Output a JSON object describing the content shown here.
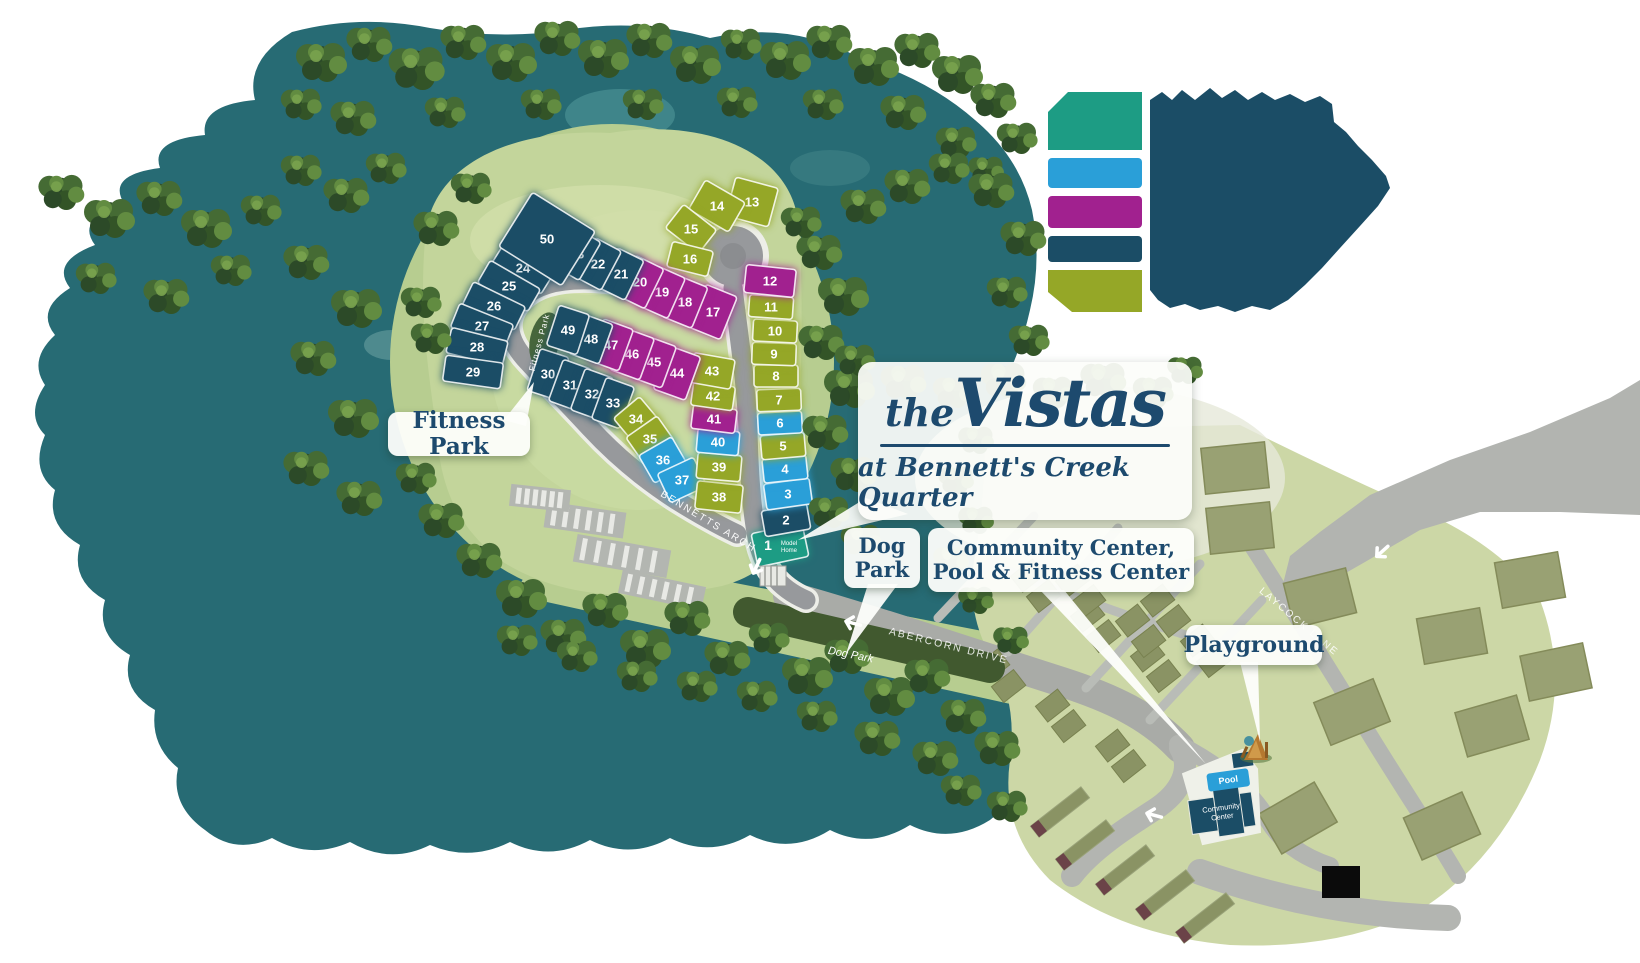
{
  "title": {
    "prefix": "the",
    "name": "Vistas",
    "subtitle": "at Bennett's Creek Quarter"
  },
  "callouts": {
    "fitness_park": "Fitness Park",
    "dog_park_line1": "Dog",
    "dog_park_line2": "Park",
    "community_line1": "Community Center,",
    "community_line2": "Pool & Fitness Center",
    "playground": "Playground"
  },
  "streets": {
    "bennetts_arch": "BENNETTS ARCH",
    "abercorn_drive": "ABERCORN DRIVE",
    "laycock_lane": "LAYCOCK LANE",
    "fitness_park_road": "Fitness Park"
  },
  "park_labels": {
    "dog_park_strip": "Dog Park"
  },
  "amenities": {
    "pool": "Pool",
    "community_center_line1": "Community",
    "community_center_line2": "Center",
    "model_home_number": "1",
    "model_home_line1": "Model",
    "model_home_line2": "Home"
  },
  "legend": {
    "swatches": [
      {
        "name": "teal",
        "hex": "#1d9c84"
      },
      {
        "name": "blue",
        "hex": "#2a9fd8"
      },
      {
        "name": "purple",
        "hex": "#a1218f"
      },
      {
        "name": "navy",
        "hex": "#1b4d66"
      },
      {
        "name": "olive",
        "hex": "#95a727"
      }
    ]
  },
  "lot_categories": {
    "navy": "#1b4d66",
    "olive": "#95a727",
    "purple": "#a1218f",
    "blue": "#2a9fd8",
    "teal": "#1d9c84"
  },
  "lots": [
    {
      "n": "1",
      "cat": "teal",
      "x": 780,
      "y": 545,
      "w": 52,
      "h": 34,
      "r": -12,
      "model_home": true
    },
    {
      "n": "2",
      "cat": "navy",
      "x": 786,
      "y": 520,
      "w": 46,
      "h": 26,
      "r": -10
    },
    {
      "n": "3",
      "cat": "blue",
      "x": 788,
      "y": 494,
      "w": 46,
      "h": 26,
      "r": -8
    },
    {
      "n": "4",
      "cat": "blue",
      "x": 785,
      "y": 469,
      "w": 44,
      "h": 24,
      "r": -6
    },
    {
      "n": "5",
      "cat": "olive",
      "x": 783,
      "y": 446,
      "w": 44,
      "h": 24,
      "r": -5
    },
    {
      "n": "6",
      "cat": "blue",
      "x": 780,
      "y": 423,
      "w": 44,
      "h": 22,
      "r": -3
    },
    {
      "n": "7",
      "cat": "olive",
      "x": 779,
      "y": 400,
      "w": 44,
      "h": 22,
      "r": -2
    },
    {
      "n": "8",
      "cat": "olive",
      "x": 776,
      "y": 376,
      "w": 44,
      "h": 22,
      "r": 0
    },
    {
      "n": "9",
      "cat": "olive",
      "x": 774,
      "y": 354,
      "w": 44,
      "h": 22,
      "r": 2
    },
    {
      "n": "10",
      "cat": "olive",
      "x": 775,
      "y": 331,
      "w": 44,
      "h": 22,
      "r": 3
    },
    {
      "n": "11",
      "cat": "olive",
      "x": 771,
      "y": 307,
      "w": 44,
      "h": 22,
      "r": 4
    },
    {
      "n": "12",
      "cat": "purple",
      "x": 770,
      "y": 281,
      "w": 50,
      "h": 28,
      "r": 6
    },
    {
      "n": "13",
      "cat": "olive",
      "x": 752,
      "y": 202,
      "w": 44,
      "h": 40,
      "r": 15
    },
    {
      "n": "14",
      "cat": "olive",
      "x": 717,
      "y": 206,
      "w": 46,
      "h": 34,
      "r": 30
    },
    {
      "n": "15",
      "cat": "olive",
      "x": 691,
      "y": 229,
      "w": 42,
      "h": 30,
      "r": 38
    },
    {
      "n": "16",
      "cat": "olive",
      "x": 690,
      "y": 259,
      "w": 42,
      "h": 26,
      "r": 14
    },
    {
      "n": "17",
      "cat": "purple",
      "x": 713,
      "y": 312,
      "w": 34,
      "h": 46,
      "r": 22
    },
    {
      "n": "18",
      "cat": "purple",
      "x": 685,
      "y": 302,
      "w": 32,
      "h": 44,
      "r": 22
    },
    {
      "n": "19",
      "cat": "purple",
      "x": 662,
      "y": 292,
      "w": 32,
      "h": 44,
      "r": 24
    },
    {
      "n": "20",
      "cat": "purple",
      "x": 640,
      "y": 282,
      "w": 32,
      "h": 44,
      "r": 26
    },
    {
      "n": "21",
      "cat": "navy",
      "x": 621,
      "y": 274,
      "w": 30,
      "h": 44,
      "r": 26
    },
    {
      "n": "22",
      "cat": "navy",
      "x": 598,
      "y": 264,
      "w": 30,
      "h": 44,
      "r": 28
    },
    {
      "n": "23",
      "cat": "navy",
      "x": 577,
      "y": 254,
      "w": 30,
      "h": 44,
      "r": 30
    },
    {
      "n": "24",
      "cat": "navy",
      "x": 523,
      "y": 268,
      "w": 58,
      "h": 26,
      "r": 32
    },
    {
      "n": "25",
      "cat": "navy",
      "x": 509,
      "y": 286,
      "w": 58,
      "h": 26,
      "r": 30
    },
    {
      "n": "26",
      "cat": "navy",
      "x": 494,
      "y": 306,
      "w": 58,
      "h": 26,
      "r": 26
    },
    {
      "n": "27",
      "cat": "navy",
      "x": 482,
      "y": 326,
      "w": 58,
      "h": 26,
      "r": 22
    },
    {
      "n": "28",
      "cat": "navy",
      "x": 477,
      "y": 347,
      "w": 58,
      "h": 26,
      "r": 14
    },
    {
      "n": "29",
      "cat": "navy",
      "x": 473,
      "y": 372,
      "w": 58,
      "h": 26,
      "r": 8
    },
    {
      "n": "30",
      "cat": "navy",
      "x": 548,
      "y": 374,
      "w": 30,
      "h": 44,
      "r": 18
    },
    {
      "n": "31",
      "cat": "navy",
      "x": 570,
      "y": 385,
      "w": 30,
      "h": 44,
      "r": 20
    },
    {
      "n": "32",
      "cat": "navy",
      "x": 592,
      "y": 394,
      "w": 30,
      "h": 44,
      "r": 20
    },
    {
      "n": "33",
      "cat": "navy",
      "x": 613,
      "y": 403,
      "w": 30,
      "h": 44,
      "r": 20
    },
    {
      "n": "34",
      "cat": "olive",
      "x": 636,
      "y": 419,
      "w": 34,
      "h": 30,
      "r": -40
    },
    {
      "n": "35",
      "cat": "olive",
      "x": 650,
      "y": 439,
      "w": 38,
      "h": 30,
      "r": -35
    },
    {
      "n": "36",
      "cat": "blue",
      "x": 663,
      "y": 460,
      "w": 38,
      "h": 32,
      "r": -30
    },
    {
      "n": "37",
      "cat": "blue",
      "x": 682,
      "y": 480,
      "w": 40,
      "h": 32,
      "r": -25
    },
    {
      "n": "38",
      "cat": "olive",
      "x": 719,
      "y": 497,
      "w": 46,
      "h": 28,
      "r": 6
    },
    {
      "n": "39",
      "cat": "olive",
      "x": 719,
      "y": 467,
      "w": 44,
      "h": 26,
      "r": 5
    },
    {
      "n": "40",
      "cat": "blue",
      "x": 718,
      "y": 442,
      "w": 42,
      "h": 24,
      "r": 5
    },
    {
      "n": "41",
      "cat": "purple",
      "x": 714,
      "y": 419,
      "w": 44,
      "h": 24,
      "r": 7
    },
    {
      "n": "42",
      "cat": "olive",
      "x": 713,
      "y": 396,
      "w": 42,
      "h": 24,
      "r": 8
    },
    {
      "n": "43",
      "cat": "olive",
      "x": 712,
      "y": 371,
      "w": 42,
      "h": 30,
      "r": 10
    },
    {
      "n": "44",
      "cat": "purple",
      "x": 677,
      "y": 373,
      "w": 34,
      "h": 46,
      "r": 20
    },
    {
      "n": "45",
      "cat": "purple",
      "x": 654,
      "y": 362,
      "w": 32,
      "h": 44,
      "r": 20
    },
    {
      "n": "46",
      "cat": "purple",
      "x": 632,
      "y": 354,
      "w": 32,
      "h": 44,
      "r": 20
    },
    {
      "n": "47",
      "cat": "purple",
      "x": 611,
      "y": 345,
      "w": 32,
      "h": 44,
      "r": 20
    },
    {
      "n": "48",
      "cat": "navy",
      "x": 591,
      "y": 339,
      "w": 32,
      "h": 42,
      "r": 20
    },
    {
      "n": "49",
      "cat": "navy",
      "x": 568,
      "y": 330,
      "w": 32,
      "h": 42,
      "r": 18
    },
    {
      "n": "50",
      "cat": "navy",
      "x": 547,
      "y": 239,
      "w": 74,
      "h": 64,
      "r": 32
    }
  ]
}
